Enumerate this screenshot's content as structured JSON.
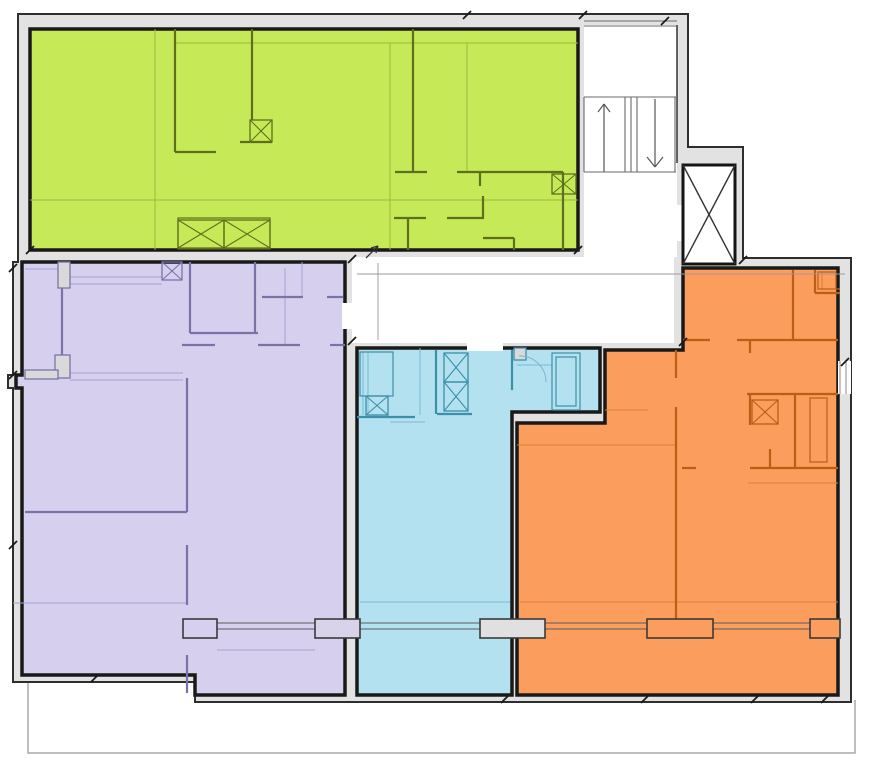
{
  "meta": {
    "canvas": {
      "w": 869,
      "h": 768
    },
    "background": "#ffffff"
  },
  "palette": {
    "envelope_fill": "#e2e2e2",
    "envelope_stroke": "#2e2e2e",
    "unit_edge": "#191919",
    "white": "#ffffff",
    "stair_line": "#6a6a6a",
    "dim_line": "#9a9a9a",
    "tick": "#1a1a1a",
    "glazing": "#5a5a5a",
    "pier_stroke": "#3a3a3a"
  },
  "floorplan": {
    "balcony": {
      "points": "28,683 28,753 855,753 855,700",
      "stroke": "#a8a8a8"
    },
    "footprint": {
      "points": "18,14 688,14 688,147 743,147 743,258 851,258 851,702 195,702 195,682 13,682 13,388 8,388 8,375 13,375 13,262 18,262"
    },
    "white_areas": [
      {
        "id": "stair-hall-area",
        "x": 584,
        "y": 25,
        "w": 93,
        "h": 232
      },
      {
        "id": "corridor-area",
        "x": 352,
        "y": 257,
        "w": 322,
        "h": 86
      }
    ],
    "units": [
      {
        "id": "unit-green-apartment",
        "fill": "#c6ea57",
        "wall_color": "#606f1c",
        "thin_color": "#9fb63d",
        "points": "30,29 578,29 578,250 30,250",
        "walls": [
          [
            413,
            29,
            413,
            172
          ],
          [
            395,
            172,
            427,
            172
          ],
          [
            457,
            172,
            563,
            172
          ],
          [
            480,
            172,
            480,
            186
          ],
          [
            563,
            172,
            563,
            250
          ],
          [
            175,
            29,
            175,
            152
          ],
          [
            175,
            152,
            216,
            152
          ],
          [
            252,
            29,
            252,
            120
          ],
          [
            240,
            142,
            272,
            142
          ],
          [
            408,
            218,
            408,
            250
          ],
          [
            394,
            218,
            426,
            218
          ],
          [
            447,
            218,
            484,
            218
          ],
          [
            483,
            196,
            483,
            218
          ],
          [
            483,
            238,
            514,
            238
          ],
          [
            514,
            238,
            514,
            250
          ]
        ],
        "thin": [
          [
            155,
            29,
            155,
            250
          ],
          [
            390,
            43,
            390,
            250
          ],
          [
            175,
            43,
            578,
            43
          ],
          [
            30,
            200,
            578,
            200
          ],
          [
            467,
            43,
            467,
            172
          ]
        ],
        "xboxes": [
          [
            250,
            120,
            22,
            22
          ],
          [
            552,
            174,
            24,
            20
          ],
          [
            178,
            220,
            46,
            28
          ],
          [
            224,
            220,
            46,
            28
          ]
        ],
        "boxes": [
          [
            178,
            218,
            92,
            31
          ]
        ],
        "blocks": [],
        "arcs": []
      },
      {
        "id": "unit-purple-apartment",
        "fill": "#d6d0ee",
        "wall_color": "#7b73a8",
        "thin_color": "#a89fd2",
        "points": "22,262 345,262 345,695 195,695 195,675 22,675 22,388 16,388 16,375 22,375",
        "walls": [
          [
            190,
            262,
            190,
            333
          ],
          [
            190,
            333,
            258,
            333
          ],
          [
            255,
            262,
            255,
            333
          ],
          [
            182,
            345,
            215,
            345
          ],
          [
            258,
            345,
            300,
            345
          ],
          [
            330,
            345,
            345,
            345
          ],
          [
            262,
            297,
            303,
            297
          ],
          [
            327,
            297,
            343,
            297
          ],
          [
            187,
            378,
            187,
            512
          ],
          [
            25,
            512,
            187,
            512
          ],
          [
            187,
            545,
            187,
            605
          ],
          [
            187,
            655,
            187,
            693
          ],
          [
            62,
            288,
            62,
            355
          ]
        ],
        "thin": [
          [
            70,
            277,
            162,
            277
          ],
          [
            70,
            284,
            162,
            284
          ],
          [
            70,
            373,
            183,
            373
          ],
          [
            70,
            380,
            183,
            380
          ],
          [
            285,
            268,
            285,
            345
          ],
          [
            302,
            262,
            302,
            297
          ],
          [
            13,
            603,
            187,
            603
          ],
          [
            217,
            650,
            315,
            650
          ],
          [
            25,
            269,
            58,
            269
          ]
        ],
        "xboxes": [
          [
            162,
            262,
            20,
            18
          ]
        ],
        "boxes": [],
        "blocks": [
          [
            58,
            262,
            12,
            26
          ],
          [
            55,
            355,
            15,
            23
          ],
          [
            25,
            370,
            33,
            9
          ]
        ],
        "arcs": []
      },
      {
        "id": "unit-cyan-apartment",
        "fill": "#b3e1f0",
        "wall_color": "#3e8fa8",
        "thin_color": "#79b9cf",
        "points": "357,348 600,348 600,412 512,412 512,695 357,695",
        "walls": [
          [
            357,
            417,
            415,
            417
          ],
          [
            437,
            414,
            472,
            414
          ],
          [
            512,
            350,
            512,
            390
          ],
          [
            436,
            350,
            436,
            414
          ]
        ],
        "thin": [
          [
            363,
            352,
            363,
            415
          ],
          [
            368,
            352,
            368,
            415
          ],
          [
            420,
            348,
            420,
            415
          ],
          [
            393,
            352,
            393,
            396
          ],
          [
            517,
            365,
            552,
            365
          ],
          [
            390,
            422,
            425,
            422
          ],
          [
            360,
            602,
            510,
            602
          ]
        ],
        "xboxes": [
          [
            366,
            396,
            22,
            19
          ],
          [
            444,
            353,
            24,
            29
          ],
          [
            444,
            382,
            24,
            29
          ]
        ],
        "boxes": [
          [
            360,
            352,
            33,
            44
          ],
          [
            552,
            353,
            28,
            57
          ],
          [
            556,
            357,
            20,
            49
          ]
        ],
        "blocks": [
          [
            514,
            348,
            12,
            12
          ]
        ],
        "arcs": [
          "M 519,356 A 26 26 0 0 1 546,382"
        ]
      },
      {
        "id": "unit-orange-apartment",
        "fill": "#fb9d5c",
        "wall_color": "#bc5e16",
        "thin_color": "#da8133",
        "points": "683,268 838,268 838,695 517,695 517,423 605,423 605,350 683,350",
        "walls": [
          [
            793,
            270,
            793,
            340
          ],
          [
            683,
            340,
            710,
            340
          ],
          [
            737,
            340,
            838,
            340
          ],
          [
            750,
            340,
            750,
            353
          ],
          [
            747,
            394,
            838,
            394
          ],
          [
            750,
            394,
            750,
            425
          ],
          [
            795,
            394,
            795,
            468
          ],
          [
            750,
            468,
            838,
            468
          ],
          [
            770,
            449,
            770,
            468
          ],
          [
            676,
            350,
            676,
            378
          ],
          [
            676,
            407,
            676,
            628
          ],
          [
            682,
            468,
            696,
            468
          ],
          [
            815,
            270,
            815,
            293
          ],
          [
            815,
            293,
            840,
            293
          ]
        ],
        "thin": [
          [
            748,
            483,
            838,
            483
          ],
          [
            517,
            445,
            677,
            445
          ],
          [
            520,
            602,
            838,
            602
          ],
          [
            822,
            272,
            822,
            289
          ],
          [
            822,
            289,
            840,
            289
          ],
          [
            605,
            410,
            648,
            410
          ]
        ],
        "xboxes": [
          [
            752,
            400,
            26,
            24
          ]
        ],
        "boxes": [
          [
            818,
            272,
            18,
            17
          ],
          [
            810,
            398,
            17,
            64
          ]
        ],
        "blocks": [],
        "arcs": []
      }
    ],
    "door_gaps": [
      {
        "x": 342,
        "y": 303,
        "w": 16,
        "h": 26
      },
      {
        "x": 467,
        "y": 343,
        "w": 36,
        "h": 8
      },
      {
        "x": 676,
        "y": 205,
        "w": 8,
        "h": 36
      }
    ],
    "facade": {
      "piers": [
        {
          "x": 183,
          "y": 619,
          "w": 34,
          "h": 19,
          "fill": "#d6d0ee"
        },
        {
          "x": 315,
          "y": 619,
          "w": 45,
          "h": 19,
          "fill": "#d9d3ea"
        },
        {
          "x": 480,
          "y": 619,
          "w": 65,
          "h": 19,
          "fill": "#e0e0e0"
        },
        {
          "x": 647,
          "y": 619,
          "w": 66,
          "h": 19,
          "fill": "#fb9d5c"
        },
        {
          "x": 810,
          "y": 619,
          "w": 30,
          "h": 19,
          "fill": "#fb9d5c"
        }
      ],
      "glazing_y": [
        623,
        629
      ],
      "glazing_segments": [
        [
          217,
          315
        ],
        [
          360,
          480
        ],
        [
          545,
          647
        ],
        [
          713,
          810
        ]
      ]
    },
    "window_gap": {
      "x": 838,
      "y": 361,
      "w": 13,
      "h": 33,
      "mullions": [
        [
          840,
          361,
          840,
          394
        ],
        [
          846,
          361,
          846,
          394
        ]
      ]
    },
    "elevator": {
      "x": 683,
      "y": 165,
      "w": 52,
      "h": 99
    },
    "stairs": {
      "top_lines": [
        [
          584,
          21,
          677,
          21
        ],
        [
          584,
          26,
          677,
          26
        ]
      ],
      "landings": [
        [
          584,
          97,
          676,
          97
        ],
        [
          584,
          172,
          676,
          172
        ]
      ],
      "flights": [
        [
          584,
          97,
          584,
          172
        ],
        [
          625,
          97,
          625,
          172
        ],
        [
          631,
          97,
          631,
          172
        ],
        [
          637,
          97,
          637,
          172
        ],
        [
          675,
          97,
          675,
          172
        ]
      ],
      "up_arrow": {
        "shaft": [
          604,
          172,
          604,
          104
        ],
        "head": [
          [
            598,
            112,
            604,
            104
          ],
          [
            610,
            112,
            604,
            104
          ]
        ]
      },
      "down_arrow": {
        "shaft": [
          655,
          99,
          655,
          166
        ],
        "head": [
          [
            647,
            157,
            655,
            167
          ],
          [
            663,
            157,
            655,
            167
          ]
        ]
      }
    },
    "extra_walls": [
      [
        677,
        25,
        677,
        163
      ]
    ],
    "dims": [
      [
        357,
        274,
        845,
        274
      ],
      [
        378,
        263,
        378,
        340
      ]
    ],
    "marks": [
      [
        366,
        258,
        378,
        246
      ],
      [
        378,
        246,
        371,
        248
      ],
      [
        378,
        246,
        376,
        253
      ]
    ],
    "ticks": [
      [
        467,
        15
      ],
      [
        583,
        15
      ],
      [
        665,
        21
      ],
      [
        352,
        259
      ],
      [
        352,
        341
      ],
      [
        13,
        268
      ],
      [
        13,
        375
      ],
      [
        13,
        545
      ],
      [
        95,
        678
      ],
      [
        505,
        699
      ],
      [
        645,
        699
      ],
      [
        755,
        699
      ],
      [
        825,
        699
      ],
      [
        845,
        362
      ],
      [
        683,
        342
      ],
      [
        30,
        250
      ],
      [
        578,
        250
      ],
      [
        743,
        260
      ]
    ]
  }
}
